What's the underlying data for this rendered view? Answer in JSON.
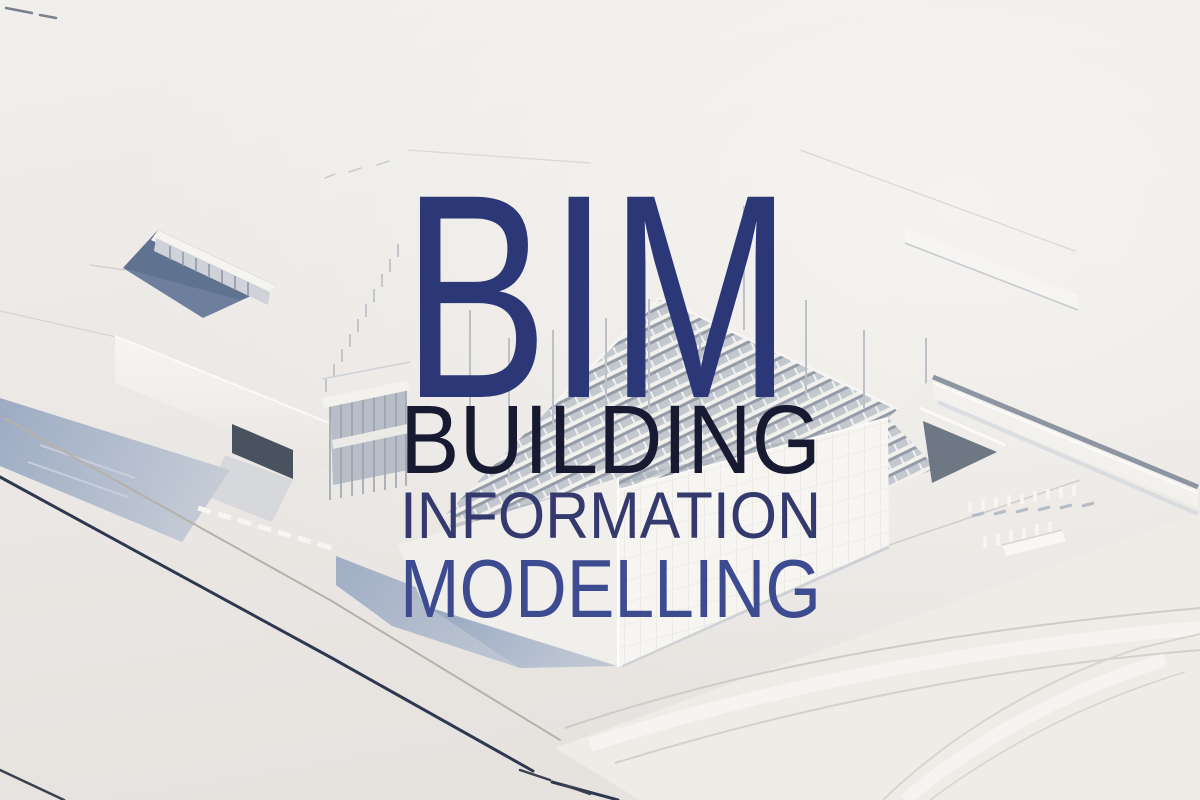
{
  "overlay": {
    "acronym": {
      "text": "BIM",
      "color": "#2c3778"
    },
    "lines": [
      {
        "text": "BUILDING",
        "color": "#171a31"
      },
      {
        "text": "INFORMATION",
        "color": "#343a6e"
      },
      {
        "text": "MODELLING",
        "color": "#3d4b90"
      }
    ]
  },
  "scene": {
    "description": "White 3D architectural massing model of a building complex seen from above",
    "background_color": "#eae7e3",
    "shadow_color": "#9fadc4"
  }
}
